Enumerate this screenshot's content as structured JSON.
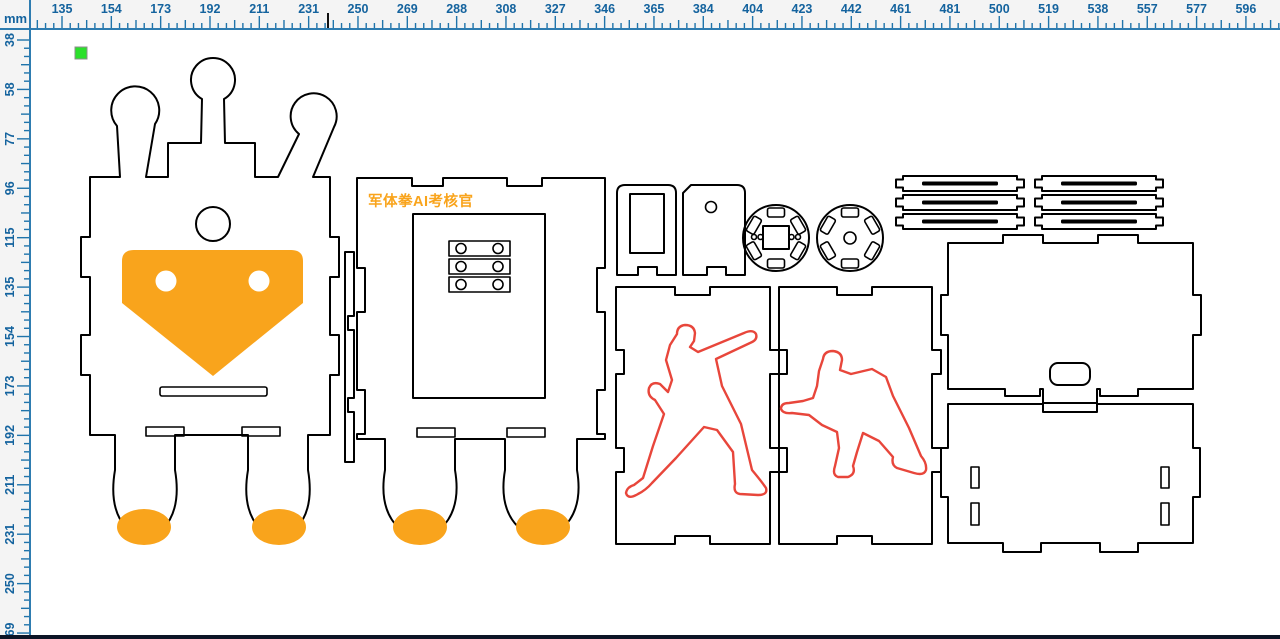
{
  "app": {
    "view": "layout-canvas"
  },
  "rulers": {
    "unit_label": "mm",
    "horizontal": {
      "labels": [
        "135",
        "154",
        "173",
        "192",
        "211",
        "231",
        "250",
        "269",
        "288",
        "308",
        "327",
        "346",
        "365",
        "384",
        "404",
        "423",
        "442",
        "461",
        "481",
        "500",
        "519",
        "538",
        "557",
        "577",
        "596"
      ],
      "origin_px": 62,
      "step_px": 49.33,
      "cursor_px": 328
    },
    "vertical": {
      "labels": [
        "38",
        "58",
        "77",
        "96",
        "115",
        "135",
        "154",
        "173",
        "192",
        "211",
        "231",
        "250",
        "269"
      ],
      "origin_px": 40,
      "step_px": 49.42
    }
  },
  "canvas": {
    "engrave_text": "军体拳AI考核官",
    "selection_marker": {
      "x": 75,
      "y": 47,
      "size": 12
    },
    "piece_names": [
      "robot-front-panel",
      "robot-back-panel",
      "side-connector-strip",
      "bracket-with-window",
      "bracket-with-hole",
      "wheel-disc-square-hub",
      "wheel-disc-round-hub",
      "slotted-strip-1",
      "slotted-strip-2",
      "slotted-strip-3",
      "slotted-strip-4",
      "slotted-strip-5",
      "slotted-strip-6",
      "top-cover-panel",
      "base-panel",
      "figure-panel-punch",
      "figure-panel-stance"
    ]
  },
  "colors": {
    "outline": "#000000",
    "accent": "#F9A41C",
    "engrave": "#E8463B",
    "marker": "#2BE02B",
    "marker_border": "#8C8C8C",
    "ruler_bg": "#F4F4F4",
    "ruler_ink": "#14639E",
    "ruler_tick": "#1F74AB",
    "ruler_line": "#2E7CB0",
    "canvas": "#FFFFFF",
    "chrome": "#EDEDED",
    "statusbar": "#0D1526",
    "cursor": "#111111"
  }
}
